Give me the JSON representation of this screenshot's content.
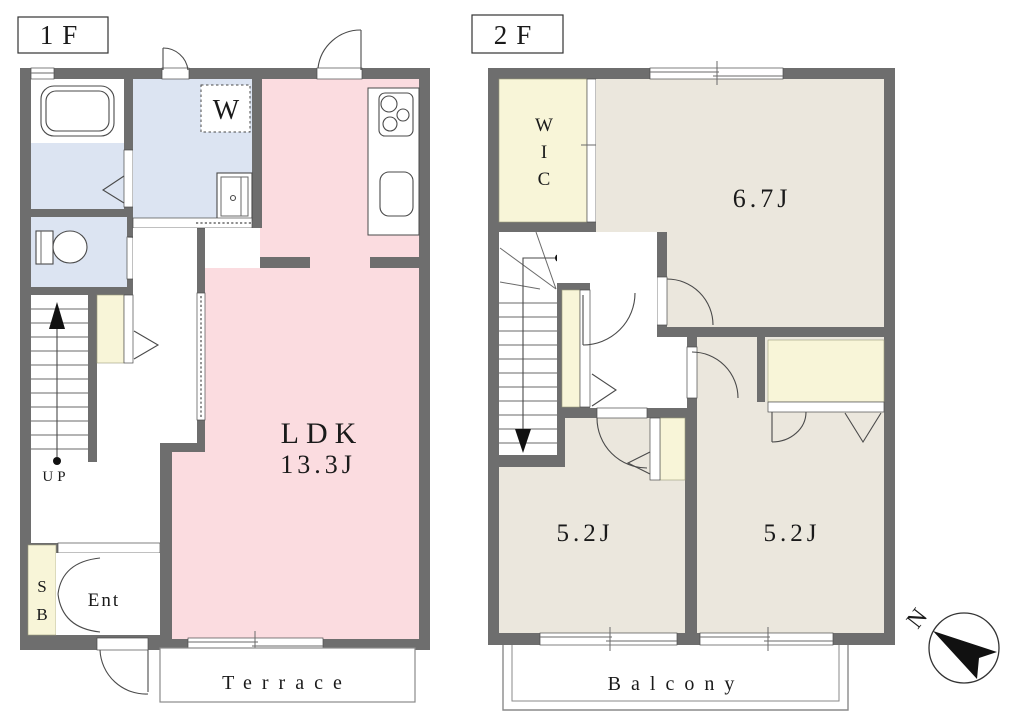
{
  "floor1": {
    "label": "1F",
    "washer_label": "W",
    "ldk_name": "LDK",
    "ldk_size": "13.3J",
    "stairs_label": "UP",
    "shoebox_lines": [
      "S",
      "B"
    ],
    "entrance_label": "Ent",
    "terrace_label": "Terrace"
  },
  "floor2": {
    "label": "2F",
    "wic_lines": [
      "W",
      "I",
      "C"
    ],
    "bedroom_main_size": "6.7J",
    "bedroom_left_size": "5.2J",
    "bedroom_right_size": "5.2J",
    "stairs_lines": [
      "D",
      "N"
    ],
    "balcony_label": "Balcony"
  },
  "compass": {
    "label": "N"
  },
  "colors": {
    "wall": "#6e6e6e",
    "ldk_pink": "#fbdce0",
    "wet_area_blue": "#dce4f2",
    "closet_cream": "#f8f5d8",
    "bedroom_beige": "#ebe7dd",
    "outline": "#4a4a4a"
  }
}
